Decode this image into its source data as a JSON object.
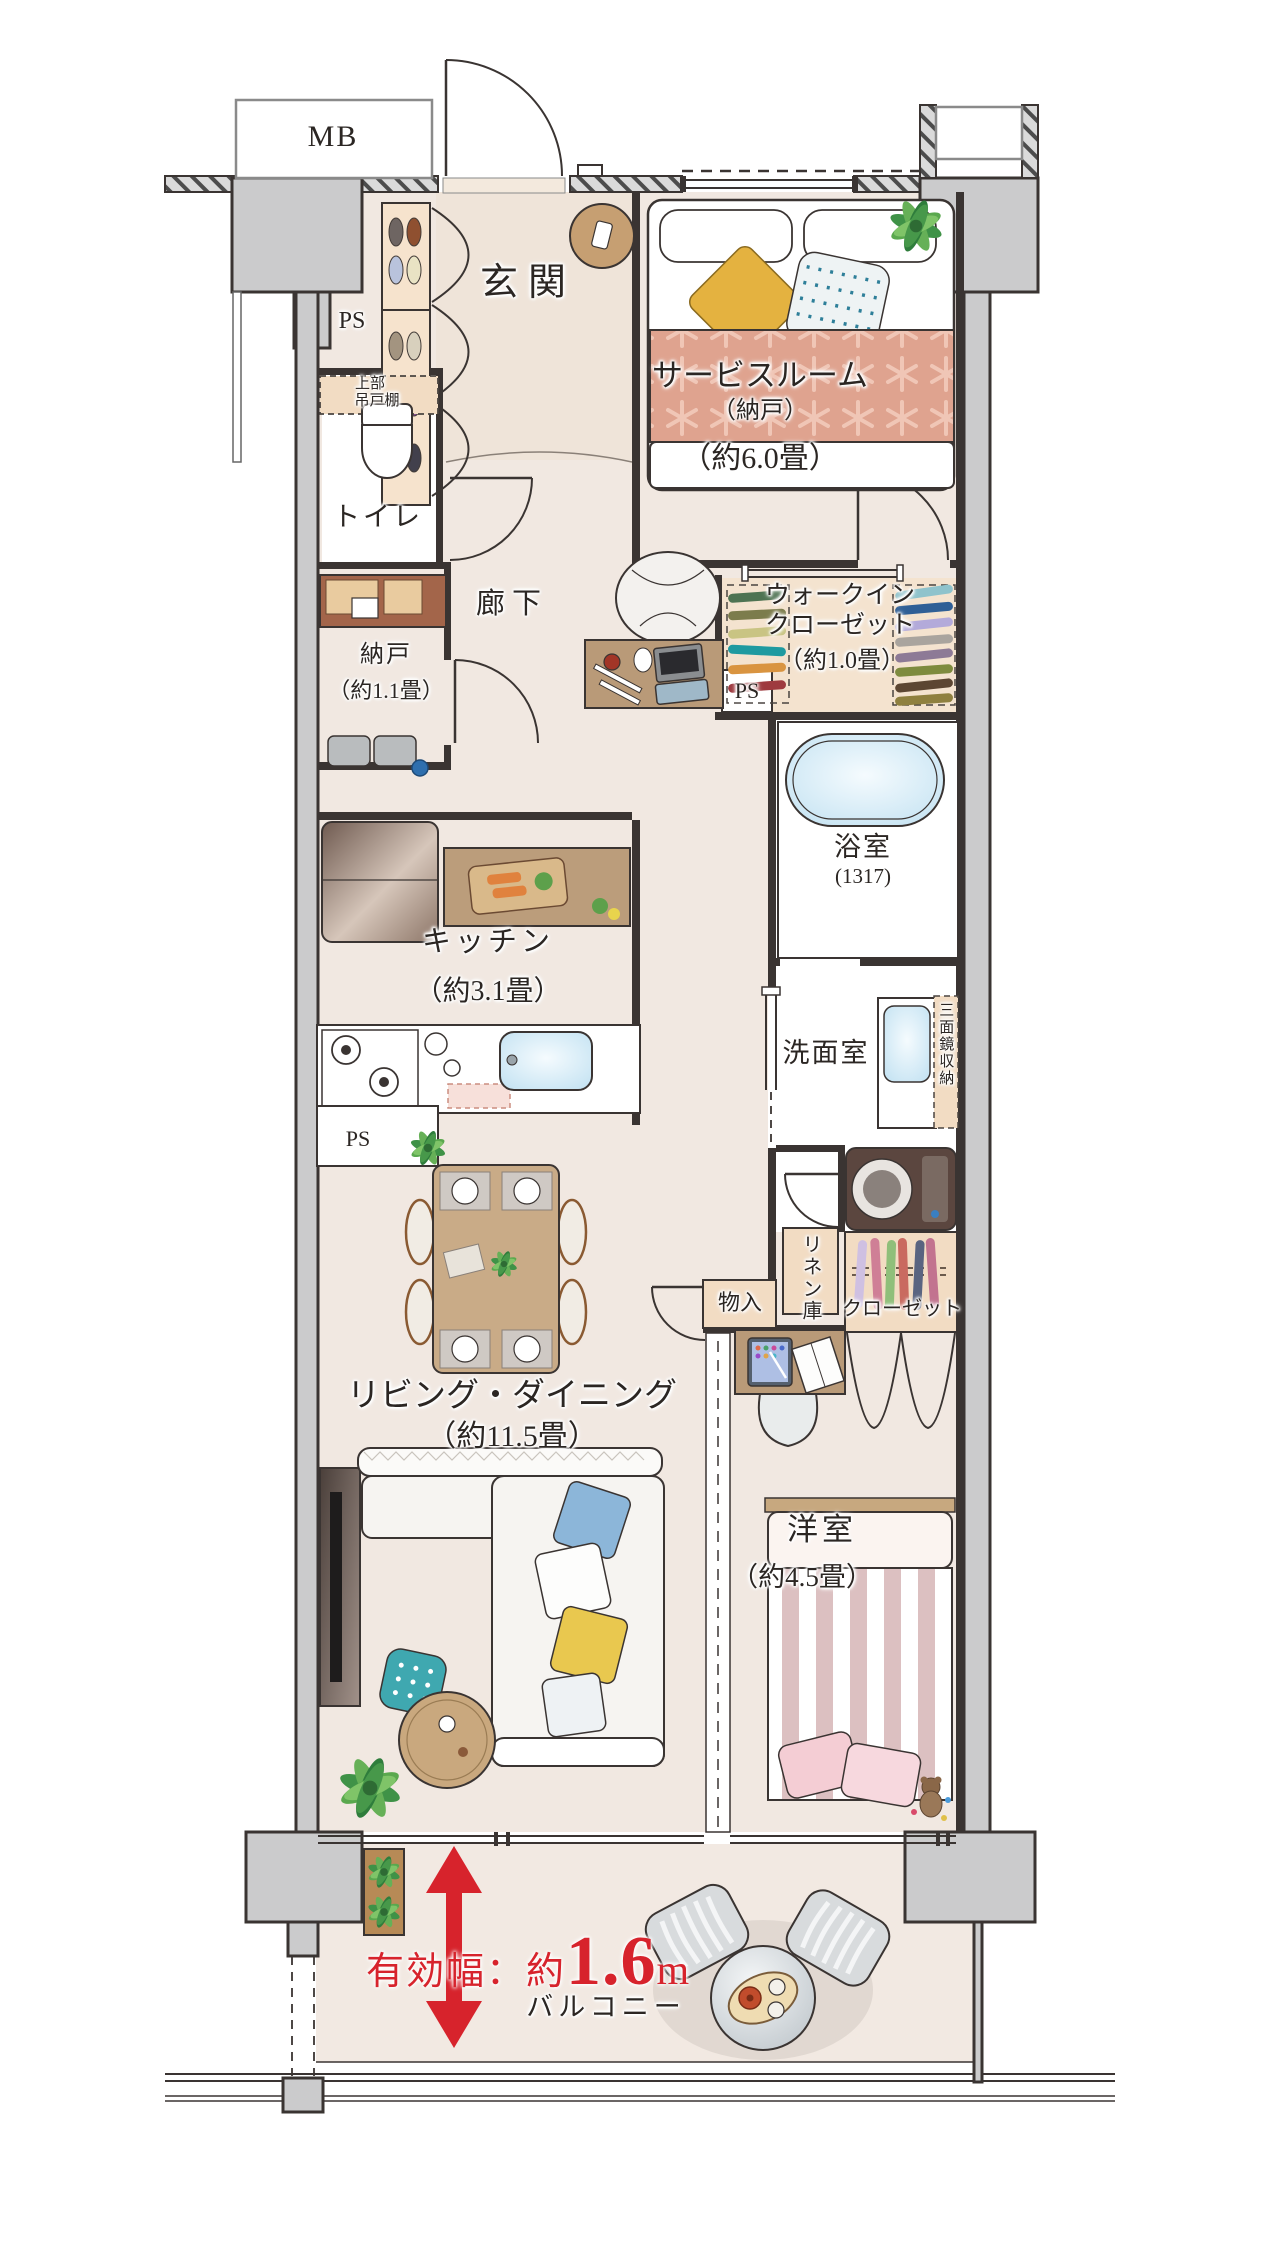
{
  "title": "マンション間取り図",
  "colors": {
    "wall": "#3a3432",
    "pillar": "#cbcbcc",
    "floor": "#f1e8e1",
    "floor_balcony": "#f2e9e2",
    "genkan": "#efe4d9",
    "closet_fill": "#f2dcc3",
    "accent_red": "#d7232c",
    "water_blue": "#d8ecf6",
    "wood": "#bb9d7b",
    "duvet_pink": "#dfa38f",
    "stripe_pink": "#dcc0c1",
    "label_ink": "#2b2623"
  },
  "rooms": {
    "mb": {
      "label": "MB"
    },
    "ps_top": {
      "label": "PS"
    },
    "entrance": {
      "label": "玄関"
    },
    "service_room": {
      "label": "サービスルーム",
      "sub": "（納戸）",
      "size": "（約6.0畳）"
    },
    "upper_cabinet": {
      "label_line1": "上部",
      "label_line2": "吊戸棚"
    },
    "toilet": {
      "label": "トイレ"
    },
    "storage_nando": {
      "label": "納戸",
      "size": "（約1.1畳）"
    },
    "hallway": {
      "label": "廊下"
    },
    "wic": {
      "label_line1": "ウォークイン",
      "label_line2": "クローゼット",
      "size": "（約1.0畳）"
    },
    "ps_mid": {
      "label": "PS"
    },
    "bathroom": {
      "label": "浴室",
      "size": "(1317)"
    },
    "kitchen": {
      "label": "キッチン",
      "size": "（約3.1畳）"
    },
    "washroom": {
      "label": "洗面室"
    },
    "mirror_cabinet": {
      "label": "三面鏡収納"
    },
    "ps_kitchen": {
      "label": "PS"
    },
    "storage_monoire": {
      "label": "物入"
    },
    "linen": {
      "label": "リネン庫"
    },
    "closet": {
      "label": "クローゼット"
    },
    "living_dining": {
      "label": "リビング・ダイニング",
      "size": "（約11.5畳）"
    },
    "western_room": {
      "label": "洋室",
      "size": "（約4.5畳）"
    },
    "balcony": {
      "label": "バルコニー",
      "width_prefix": "有効幅：約",
      "width_value": "1.6",
      "width_unit": "m"
    }
  }
}
